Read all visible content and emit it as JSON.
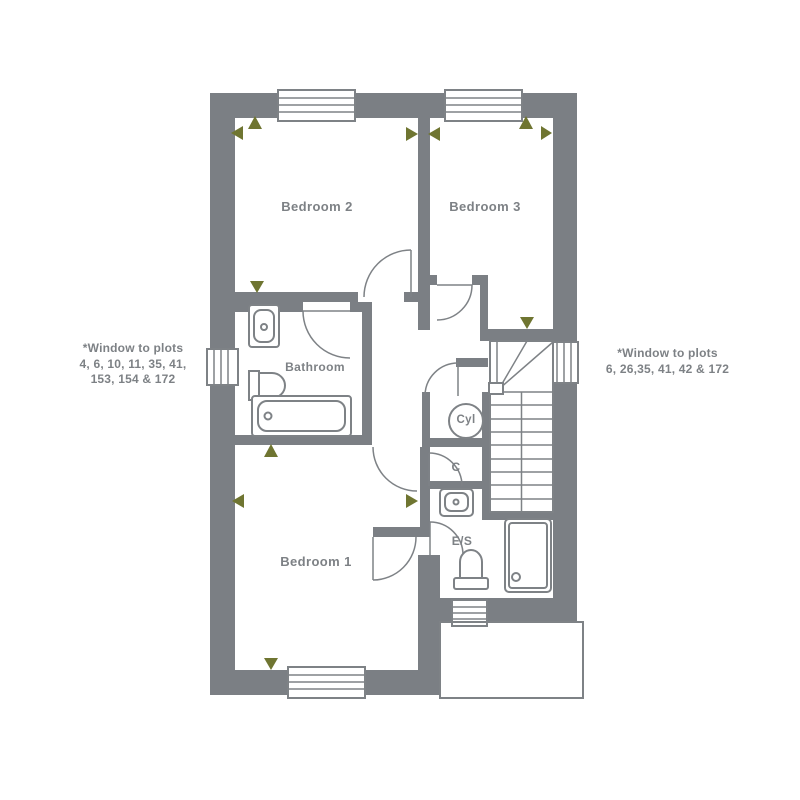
{
  "labels": {
    "bedroom2": "Bedroom 2",
    "bedroom3": "Bedroom 3",
    "bedroom1": "Bedroom 1",
    "bathroom": "Bathroom",
    "cylinder": "Cyl",
    "cupboard": "C",
    "ensuite": "E/S"
  },
  "annotations": {
    "left_line1": "*Window to plots",
    "left_line2": "4, 6, 10, 11, 35, 41,",
    "left_line3": "153, 154 & 172",
    "right_line1": "*Window to plots",
    "right_line2": "6, 26,35, 41, 42 & 172"
  },
  "colors": {
    "wall": "#7b7f84",
    "line": "#7e8286",
    "marker": "#6f7531",
    "text": "#7d8185",
    "background": "#ffffff"
  }
}
